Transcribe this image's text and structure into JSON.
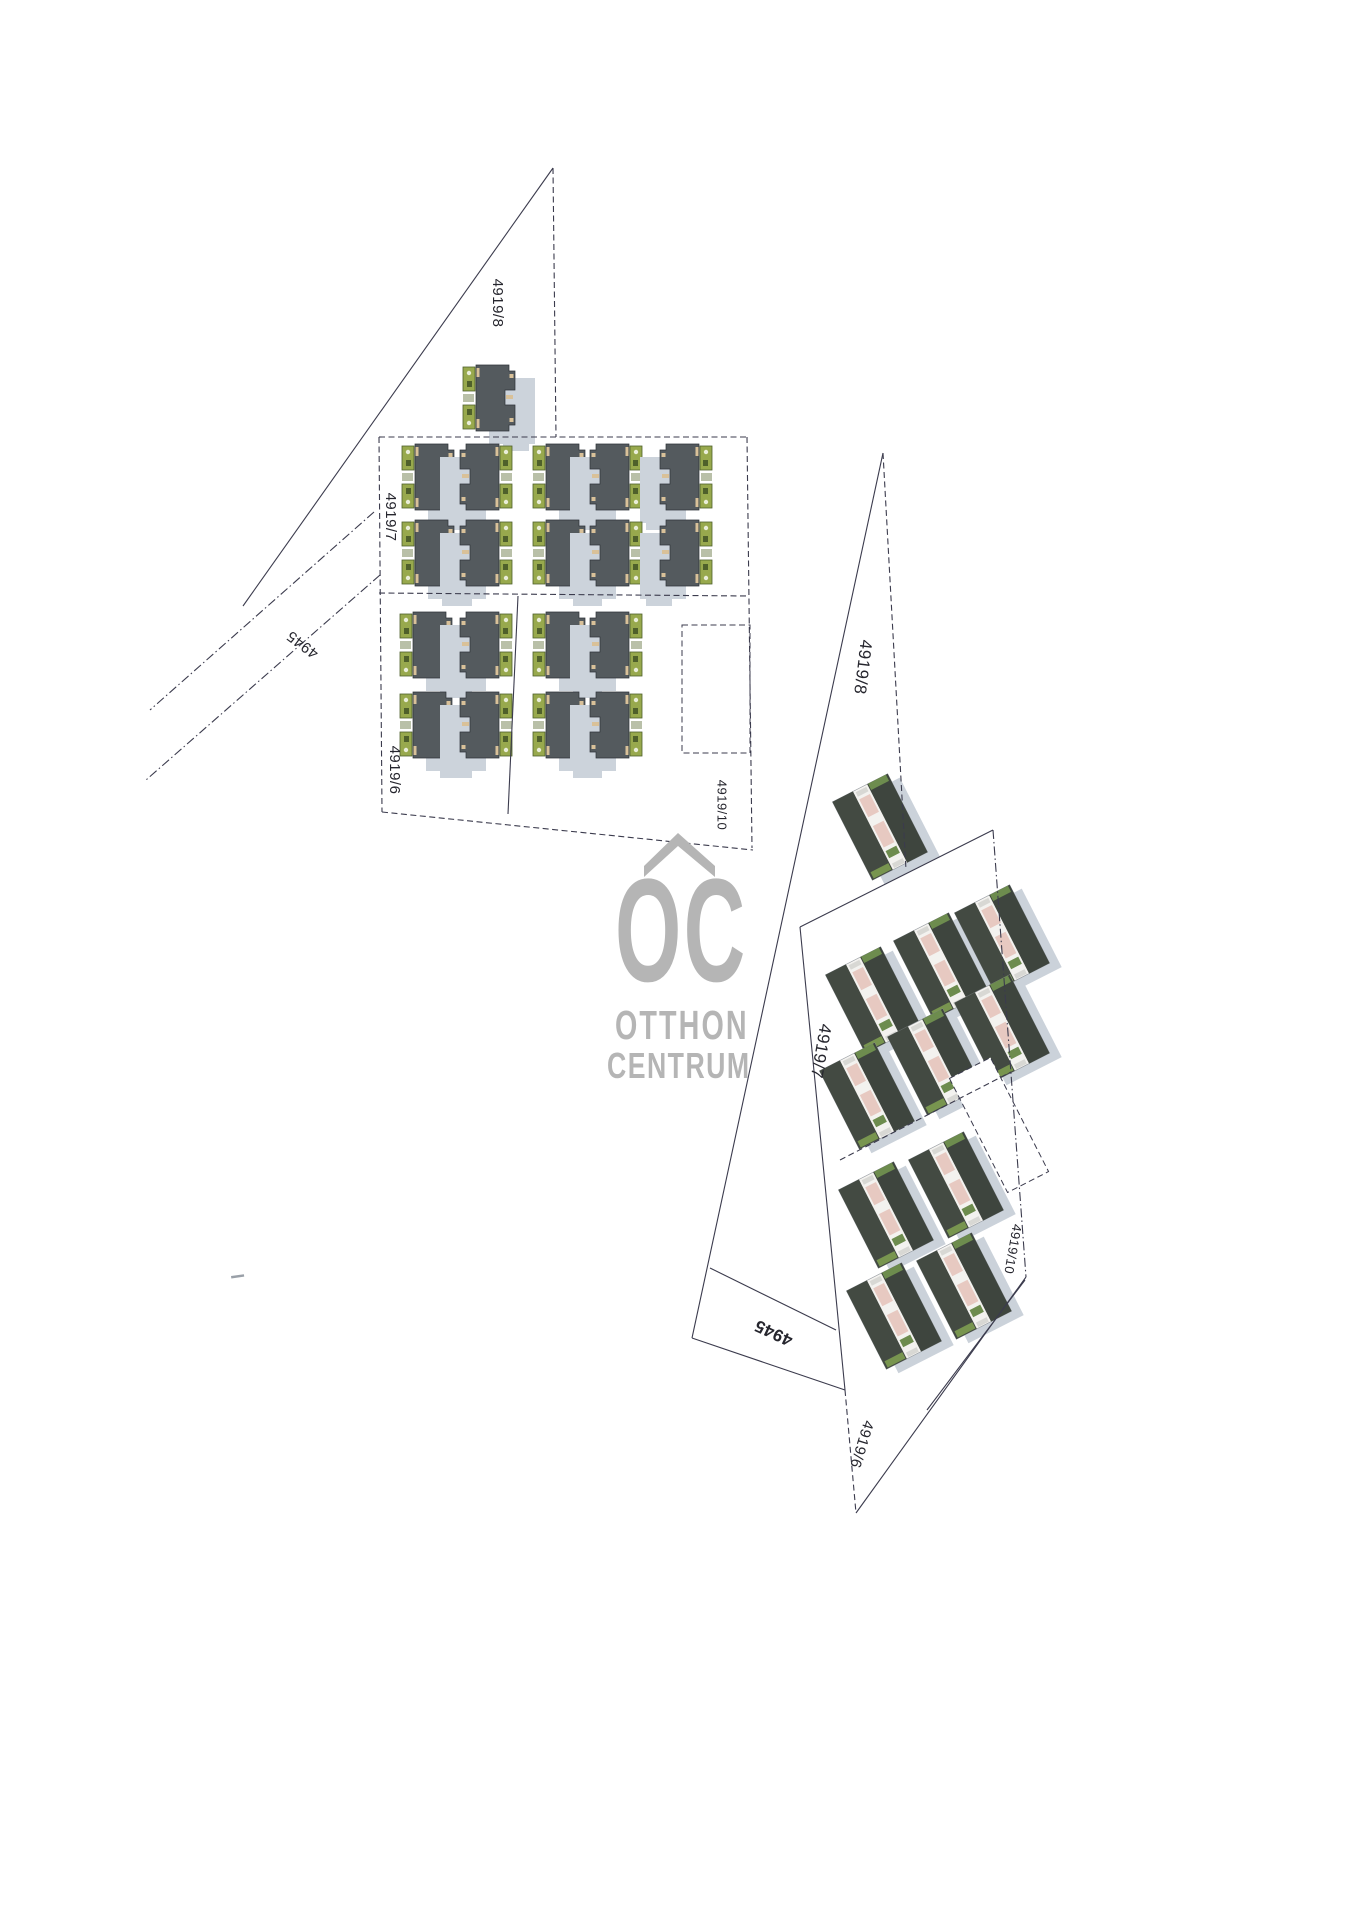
{
  "logo": {
    "mark": "OC",
    "line1": "OTTHON",
    "line2": "CENTRUM",
    "color": "#b5b5b5"
  },
  "colors": {
    "line": "#3b3b4d",
    "label": "#26262e",
    "roof": "#545a5e",
    "roof_edge": "#2e3338",
    "green": "#98a94d",
    "green_dark": "#4f602b",
    "green_mid": "#b9c0a8",
    "tan": "#d9c199",
    "shadow": "#ccd3db",
    "photo_wall": "#f3f2ef",
    "photo_roof_a": "#434a42",
    "photo_roof_b": "#3e453e",
    "photo_pink": "#e7c9c1",
    "photo_green": "#6d8c4e",
    "photo_green2": "#78954f",
    "photo_shadow": "#cbd2da"
  },
  "left_plan": {
    "labels": [
      {
        "text": "4919/8",
        "x": 497,
        "y": 303,
        "rot": 90,
        "size": 15,
        "bold": false
      },
      {
        "text": "4919/7",
        "x": 390,
        "y": 517,
        "rot": 90,
        "size": 15,
        "bold": false
      },
      {
        "text": "4945",
        "x": 303,
        "y": 644,
        "rot": 217,
        "size": 15,
        "bold": false
      },
      {
        "text": "4919/6",
        "x": 394,
        "y": 770,
        "rot": 90,
        "size": 15,
        "bold": false
      },
      {
        "text": "4919/10",
        "x": 721,
        "y": 805,
        "rot": 90,
        "size": 13,
        "bold": false
      }
    ],
    "lines": [
      {
        "x1": 553,
        "y1": 168,
        "x2": 243,
        "y2": 606,
        "dash": "solid"
      },
      {
        "x1": 553,
        "y1": 168,
        "x2": 556,
        "y2": 437,
        "dash": "dash"
      },
      {
        "x1": 374,
        "y1": 512,
        "x2": 150,
        "y2": 710,
        "dash": "dashdot"
      },
      {
        "x1": 380,
        "y1": 575,
        "x2": 146,
        "y2": 780,
        "dash": "dashdot"
      },
      {
        "x1": 379,
        "y1": 437,
        "x2": 747,
        "y2": 437,
        "dash": "dash"
      },
      {
        "x1": 379,
        "y1": 437,
        "x2": 382,
        "y2": 812,
        "dash": "dash"
      },
      {
        "x1": 747,
        "y1": 437,
        "x2": 752,
        "y2": 848,
        "dash": "dash"
      },
      {
        "x1": 382,
        "y1": 812,
        "x2": 753,
        "y2": 850,
        "dash": "dash"
      },
      {
        "x1": 379,
        "y1": 593,
        "x2": 749,
        "y2": 596,
        "dash": "dash"
      },
      {
        "x1": 518,
        "y1": 596,
        "x2": 508,
        "y2": 814,
        "dash": "solid"
      }
    ],
    "empty_lot": {
      "x": 682,
      "y": 625,
      "w": 68,
      "h": 128
    },
    "houses": [
      {
        "x": 463,
        "y": 365,
        "m": false
      },
      {
        "x": 402,
        "y": 444,
        "m": false
      },
      {
        "x": 460,
        "y": 444,
        "m": true
      },
      {
        "x": 533,
        "y": 444,
        "m": false
      },
      {
        "x": 590,
        "y": 444,
        "m": true
      },
      {
        "x": 660,
        "y": 444,
        "m": true
      },
      {
        "x": 402,
        "y": 520,
        "m": false
      },
      {
        "x": 460,
        "y": 520,
        "m": true
      },
      {
        "x": 533,
        "y": 520,
        "m": false
      },
      {
        "x": 590,
        "y": 520,
        "m": true
      },
      {
        "x": 660,
        "y": 520,
        "m": true
      },
      {
        "x": 400,
        "y": 612,
        "m": false
      },
      {
        "x": 460,
        "y": 612,
        "m": true
      },
      {
        "x": 533,
        "y": 612,
        "m": false
      },
      {
        "x": 590,
        "y": 612,
        "m": true
      },
      {
        "x": 400,
        "y": 692,
        "m": false
      },
      {
        "x": 460,
        "y": 692,
        "m": true
      },
      {
        "x": 533,
        "y": 692,
        "m": false
      },
      {
        "x": 590,
        "y": 692,
        "m": true
      }
    ]
  },
  "right_plan": {
    "house_rot": -27,
    "labels": [
      {
        "text": "4919/8",
        "x": 862,
        "y": 667,
        "rot": 97,
        "size": 17,
        "bold": false
      },
      {
        "text": "4919/7",
        "x": 820,
        "y": 1051,
        "rot": 100,
        "size": 17,
        "bold": false
      },
      {
        "text": "4945",
        "x": 774,
        "y": 1332,
        "rot": 205,
        "size": 17,
        "bold": true
      },
      {
        "text": "4919/6",
        "x": 861,
        "y": 1444,
        "rot": 107,
        "size": 15,
        "bold": false
      },
      {
        "text": "4919/10",
        "x": 1012,
        "y": 1249,
        "rot": 100,
        "size": 13,
        "bold": false
      }
    ],
    "lines": [
      {
        "x1": 883,
        "y1": 453,
        "x2": 692,
        "y2": 1338,
        "dash": "solid"
      },
      {
        "x1": 883,
        "y1": 453,
        "x2": 906,
        "y2": 870,
        "dash": "dash"
      },
      {
        "x1": 800,
        "y1": 927,
        "x2": 993,
        "y2": 830,
        "dash": "solid"
      },
      {
        "x1": 993,
        "y1": 830,
        "x2": 1026,
        "y2": 1277,
        "dash": "dashdot"
      },
      {
        "x1": 1026,
        "y1": 1277,
        "x2": 856,
        "y2": 1513,
        "dash": "solid"
      },
      {
        "x1": 800,
        "y1": 927,
        "x2": 845,
        "y2": 1390,
        "dash": "solid"
      },
      {
        "x1": 845,
        "y1": 1390,
        "x2": 856,
        "y2": 1513,
        "dash": "dash"
      },
      {
        "x1": 710,
        "y1": 1268,
        "x2": 836,
        "y2": 1330,
        "dash": "solid"
      },
      {
        "x1": 692,
        "y1": 1338,
        "x2": 845,
        "y2": 1390,
        "dash": "solid"
      },
      {
        "x1": 840,
        "y1": 1160,
        "x2": 1011,
        "y2": 1072,
        "dash": "dash"
      },
      {
        "x1": 927,
        "y1": 1410,
        "x2": 1025,
        "y2": 1280,
        "dash": "solid"
      }
    ],
    "empty_lot": {
      "cx": 999,
      "cy": 1125,
      "w": 46,
      "h": 128
    },
    "houses": [
      {
        "cx": 880,
        "cy": 827
      },
      {
        "cx": 873,
        "cy": 1000
      },
      {
        "cx": 941,
        "cy": 966
      },
      {
        "cx": 1002,
        "cy": 938
      },
      {
        "cx": 867,
        "cy": 1096
      },
      {
        "cx": 935,
        "cy": 1062
      },
      {
        "cx": 1002,
        "cy": 1028
      },
      {
        "cx": 886,
        "cy": 1215
      },
      {
        "cx": 956,
        "cy": 1185
      },
      {
        "cx": 894,
        "cy": 1316
      },
      {
        "cx": 964,
        "cy": 1286
      }
    ]
  },
  "artifact": {
    "x": 231,
    "y": 1276
  }
}
